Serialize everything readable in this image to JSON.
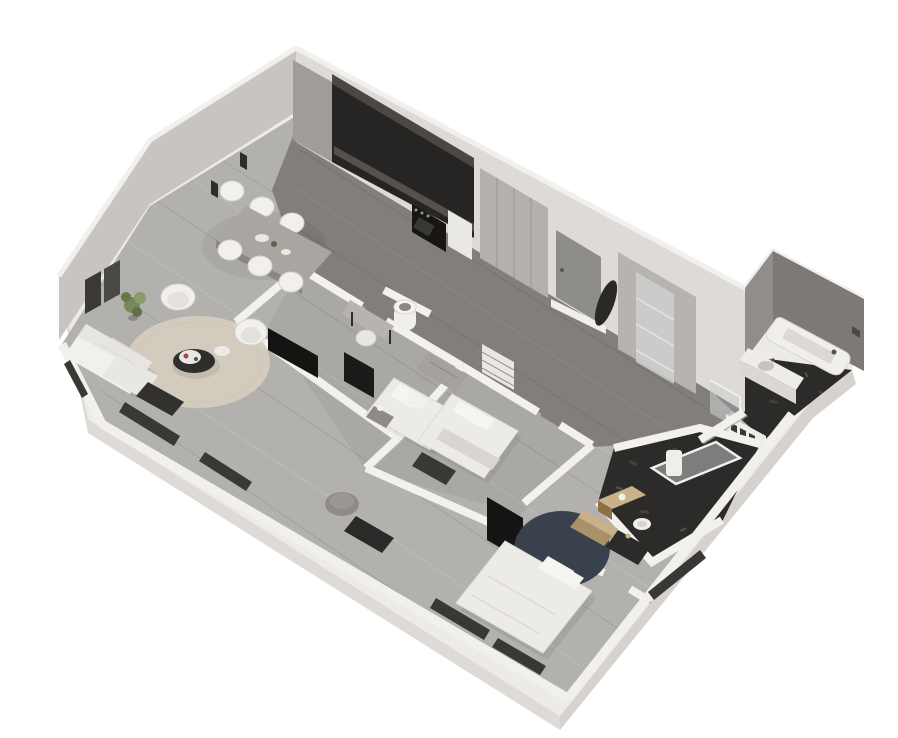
{
  "scene": {
    "kind": "isometric-3d-floor-plan-render",
    "description": "Dollhouse-style 3D floor plan of an apartment viewed from above at an angle, white background, no text labels",
    "background": "#ffffff"
  },
  "palette": {
    "slab": "#edebe8",
    "slabEdge": "#d6d3cf",
    "slabEdge2": "#dedbd7",
    "wallFace": "#c8c5c1",
    "facade": "#dedbd7",
    "rim": "#f2f0ed",
    "floorLight": "#b3b1ae",
    "floorDark": "#827e7a",
    "plankLight": "#c6c4c1",
    "plankDark": "#8f8c88",
    "marble": "#2d2b29",
    "marbleSpeck": "#55524e",
    "cabinetDark": "#272523",
    "cabinetTop": "#4a4744",
    "counter": "#55524e",
    "ovenBlack": "#171615",
    "doorGray": "#8f8d89",
    "wardrobe": "#b4b1ad",
    "glassTint": "#ccd0cf",
    "innerWall": "#f3f1ed",
    "innerWallShadow": "#c2bfbb",
    "bathFaceNW": "#918e8a",
    "bathFaceNE": "#7d7974",
    "furnWhite": "#f2f0ec",
    "bedWhite": "#ecebe6",
    "pillowWhite": "#f7f5f1",
    "blanketGray": "#d9d6d1",
    "throwDark": "#514f4c",
    "benchDark": "#3a3835",
    "tvBlack": "#141413",
    "rugBeige": "#d5cdbf",
    "rugNavy": "#39424c",
    "plantGreen": "#77895c",
    "plantGreenDark": "#5f7048",
    "brass": "#ab9166",
    "brassTop": "#c9b28a",
    "brassDark": "#8d6f45",
    "ottomanGray": "#8f8c88",
    "artFrame": "#3b3936",
    "windowDark": "#3a3835",
    "shadow": "#000000"
  },
  "rooms": [
    {
      "name": "living-room",
      "furniture": [
        "white-sofa",
        "armchair",
        "armchair",
        "round-beige-rug",
        "coffee-table-tray",
        "potted-plant",
        "media-bench",
        "side-table",
        "ottoman",
        "dark-bench"
      ]
    },
    {
      "name": "dining-area",
      "furniture": [
        "dining-table",
        "dining-chair",
        "dining-chair",
        "dining-chair",
        "dining-chair",
        "dining-chair",
        "dining-chair"
      ]
    },
    {
      "name": "kitchen",
      "furniture": [
        "dark-cabinet-run",
        "end-panel",
        "counter",
        "built-in-oven",
        "white-appliance-cabinet"
      ]
    },
    {
      "name": "entry-hall",
      "furniture": [
        "entry-door",
        "ribbed-wardrobe",
        "tall-display-cabinet",
        "coat-rack",
        "glass-partition"
      ]
    },
    {
      "name": "bedroom-small",
      "furniture": [
        "single-bed",
        "desk",
        "desk-chair",
        "cylinder-washbasin",
        "nightstand-lamp",
        "gray-dresser"
      ]
    },
    {
      "name": "bedroom-middle",
      "furniture": [
        "double-bed",
        "foot-bench",
        "shelved-wardrobe"
      ]
    },
    {
      "name": "bedroom-main",
      "furniture": [
        "double-bed",
        "navy-round-rug",
        "wall-tv",
        "brass-side-table",
        "dark-nightstand"
      ]
    },
    {
      "name": "main-bathroom",
      "furniture": [
        "bathtub",
        "vanity-with-basin",
        "towel-cubby-shelf",
        "wall-fitting"
      ]
    },
    {
      "name": "shower-room",
      "furniture": [
        "glass-shower",
        "brass-vanity",
        "toilet"
      ]
    }
  ],
  "wall_decor": [
    "framed-art",
    "framed-art",
    "wall-sconce",
    "wall-sconce",
    "low-wall-windows"
  ]
}
